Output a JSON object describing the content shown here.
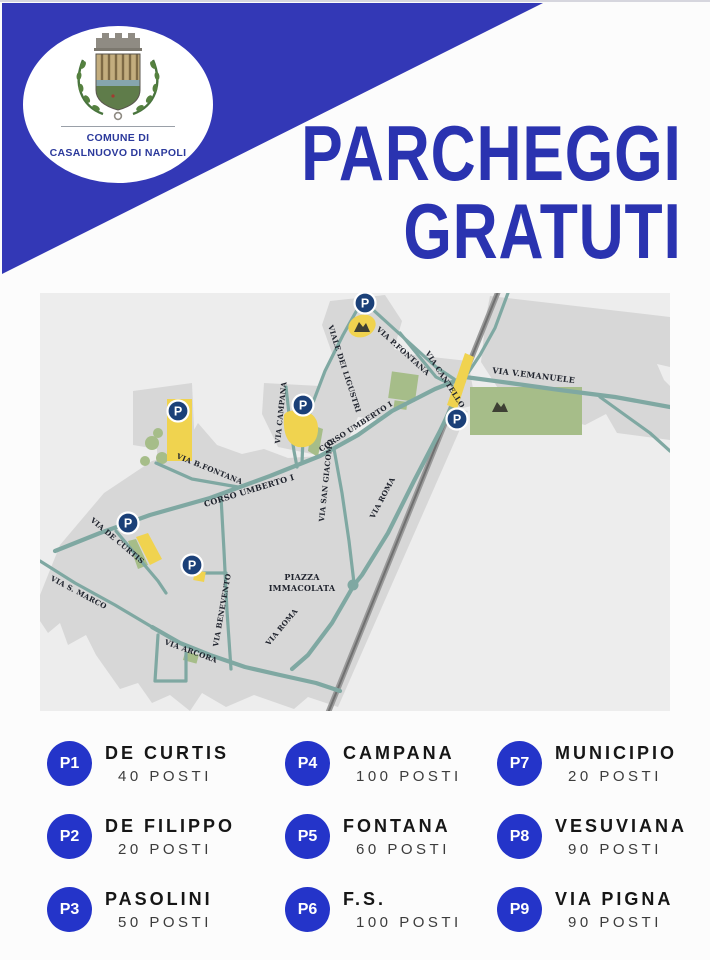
{
  "colors": {
    "page_bg": "#fcfcfc",
    "banner_blue": "#3338b6",
    "title_blue": "#2a33b0",
    "crest_text_blue": "#2c3a9c",
    "legend_badge_blue": "#2434c9",
    "map_bg": "#ededed",
    "town_gray": "#d7d7d7",
    "road_teal": "#7fa8a2",
    "railway_gray": "#8c8c8c",
    "parking_yellow": "#f0d34f",
    "green_area": "#a6bd89",
    "marker_navy": "#1b4078",
    "label_dark": "#20242e",
    "legend_title": "#161616",
    "legend_sub": "#3c3c3c"
  },
  "crest": {
    "line1": "COMUNE DI",
    "line2": "CASALNUOVO DI NAPOLI"
  },
  "title": {
    "line1": "PARCHEGGI",
    "line2": "GRATUTI"
  },
  "map": {
    "marker_letter": "P",
    "street_labels": [
      {
        "t": "VIA P.FONTANA",
        "x": 336,
        "y": 37,
        "r": 42
      },
      {
        "t": "VIALE DEI LIGUSTRI",
        "x": 288,
        "y": 33,
        "r": 72
      },
      {
        "t": "VIA CANTELLO",
        "x": 385,
        "y": 60,
        "r": 57
      },
      {
        "t": "VIA V.EMANUELE",
        "x": 452,
        "y": 80,
        "r": 7,
        "s": 8
      },
      {
        "t": "CORSO UMBERTO I",
        "x": 281,
        "y": 159,
        "r": -33
      },
      {
        "t": "CORSO UMBERTO I",
        "x": 165,
        "y": 214,
        "r": -17,
        "s": 8
      },
      {
        "t": "VIA CAMPANA",
        "x": 240,
        "y": 151,
        "r": -84
      },
      {
        "t": "VIA SAN GIACOMO",
        "x": 284,
        "y": 229,
        "r": -84
      },
      {
        "t": "VIA ROMA",
        "x": 334,
        "y": 226,
        "r": -62
      },
      {
        "t": "VIA ROMA",
        "x": 229,
        "y": 353,
        "r": -50
      },
      {
        "t": "VIA BENEVENTO",
        "x": 178,
        "y": 354,
        "r": -80
      },
      {
        "t": "VIA B.FONTANA",
        "x": 136,
        "y": 165,
        "r": 22
      },
      {
        "t": "VIA DE CURTIS",
        "x": 50,
        "y": 228,
        "r": 40
      },
      {
        "t": "VIA S. MARCO",
        "x": 10,
        "y": 287,
        "r": 28
      },
      {
        "t": "VIA ARCORA",
        "x": 124,
        "y": 351,
        "r": 20
      },
      {
        "t": "PIAZZA",
        "x": 262,
        "y": 287,
        "r": 0,
        "s": 8,
        "a": "m"
      },
      {
        "t": "IMMACOLATA",
        "x": 262,
        "y": 298,
        "r": 0,
        "s": 8,
        "a": "m"
      }
    ],
    "p_markers": [
      {
        "x": 325,
        "y": 10
      },
      {
        "x": 138,
        "y": 118
      },
      {
        "x": 263,
        "y": 112
      },
      {
        "x": 417,
        "y": 126
      },
      {
        "x": 88,
        "y": 230
      },
      {
        "x": 152,
        "y": 272
      }
    ],
    "monuments": [
      {
        "x": 322,
        "y": 34
      },
      {
        "x": 460,
        "y": 114
      }
    ]
  },
  "legend": {
    "items": [
      {
        "id": "P1",
        "name": "DE CURTIS",
        "posti": "40 POSTI"
      },
      {
        "id": "P2",
        "name": "DE FILIPPO",
        "posti": "20 POSTI"
      },
      {
        "id": "P3",
        "name": "PASOLINI",
        "posti": "50 POSTI"
      },
      {
        "id": "P4",
        "name": "CAMPANA",
        "posti": "100 POSTI"
      },
      {
        "id": "P5",
        "name": "FONTANA",
        "posti": "60 POSTI"
      },
      {
        "id": "P6",
        "name": "F.S.",
        "posti": "100 POSTI"
      },
      {
        "id": "P7",
        "name": "MUNICIPIO",
        "posti": "20 POSTI"
      },
      {
        "id": "P8",
        "name": "VESUVIANA",
        "posti": "90 POSTI"
      },
      {
        "id": "P9",
        "name": "VIA PIGNA",
        "posti": "90 POSTI"
      }
    ]
  }
}
